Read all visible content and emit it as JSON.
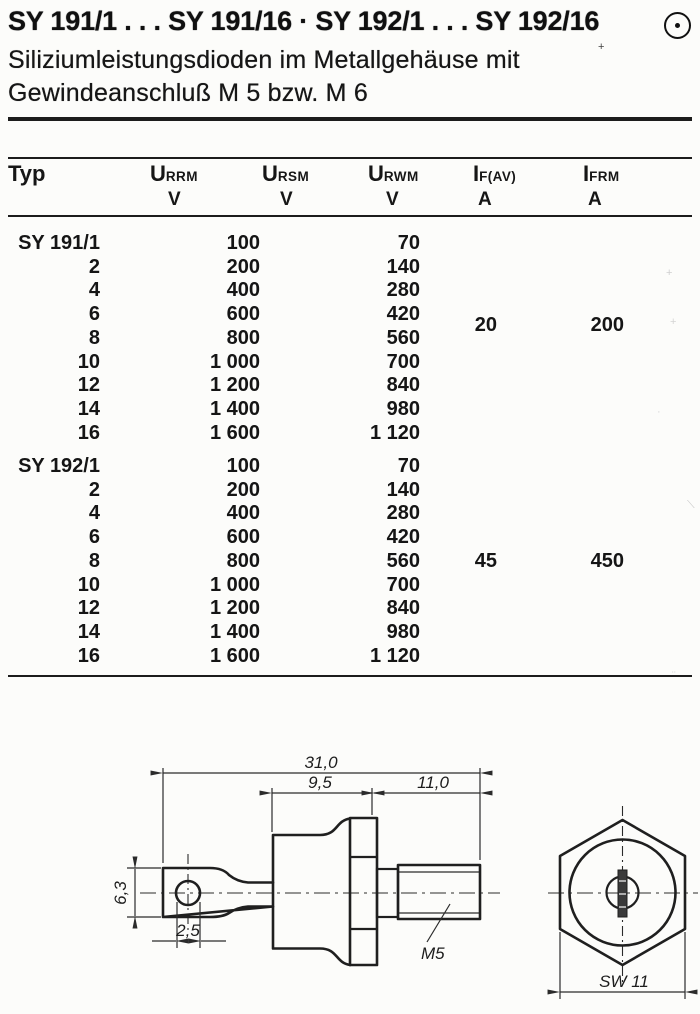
{
  "header": {
    "title": "SY 191/1 . . . SY 191/16 · SY 192/1 . . . SY 192/16",
    "logo_icon": "circled-dot",
    "subtitle_line1": "Siliziumleistungsdioden im Metallgehäuse mit",
    "subtitle_line2": "Gewindeanschluß M 5 bzw. M 6"
  },
  "table": {
    "columns": [
      {
        "label": "Typ",
        "sub": "",
        "unit": ""
      },
      {
        "label": "U",
        "sub": "RRM",
        "unit": "V"
      },
      {
        "label": "U",
        "sub": "RSM",
        "unit": "V"
      },
      {
        "label": "U",
        "sub": "RWM",
        "unit": "V"
      },
      {
        "label": "I",
        "sub": "F(AV)",
        "unit": "A"
      },
      {
        "label": "I",
        "sub": "FRM",
        "unit": "A"
      }
    ],
    "groups": [
      {
        "base_type": "SY 191",
        "if_av": "20",
        "ifrm": "200",
        "rows": [
          {
            "typ": "SY 191/1",
            "v1": "100",
            "v2": "70"
          },
          {
            "typ": "2",
            "v1": "200",
            "v2": "140"
          },
          {
            "typ": "4",
            "v1": "400",
            "v2": "280"
          },
          {
            "typ": "6",
            "v1": "600",
            "v2": "420"
          },
          {
            "typ": "8",
            "v1": "800",
            "v2": "560"
          },
          {
            "typ": "10",
            "v1": "1 000",
            "v2": "700"
          },
          {
            "typ": "12",
            "v1": "1 200",
            "v2": "840"
          },
          {
            "typ": "14",
            "v1": "1 400",
            "v2": "980"
          },
          {
            "typ": "16",
            "v1": "1 600",
            "v2": "1 120"
          }
        ]
      },
      {
        "base_type": "SY 192",
        "if_av": "45",
        "ifrm": "450",
        "rows": [
          {
            "typ": "SY 192/1",
            "v1": "100",
            "v2": "70"
          },
          {
            "typ": "2",
            "v1": "200",
            "v2": "140"
          },
          {
            "typ": "4",
            "v1": "400",
            "v2": "280"
          },
          {
            "typ": "6",
            "v1": "600",
            "v2": "420"
          },
          {
            "typ": "8",
            "v1": "800",
            "v2": "560"
          },
          {
            "typ": "10",
            "v1": "1 000",
            "v2": "700"
          },
          {
            "typ": "12",
            "v1": "1 200",
            "v2": "840"
          },
          {
            "typ": "14",
            "v1": "1 400",
            "v2": "980"
          },
          {
            "typ": "16",
            "v1": "1 600",
            "v2": "1 120"
          }
        ]
      }
    ]
  },
  "drawing": {
    "dims": {
      "overall_length": "31,0",
      "case_length": "9,5",
      "thread_length": "11,0",
      "lug_height": "6,3",
      "hole_diameter": "2,5",
      "thread_label": "M5",
      "wrench_size": "SW 11"
    }
  }
}
